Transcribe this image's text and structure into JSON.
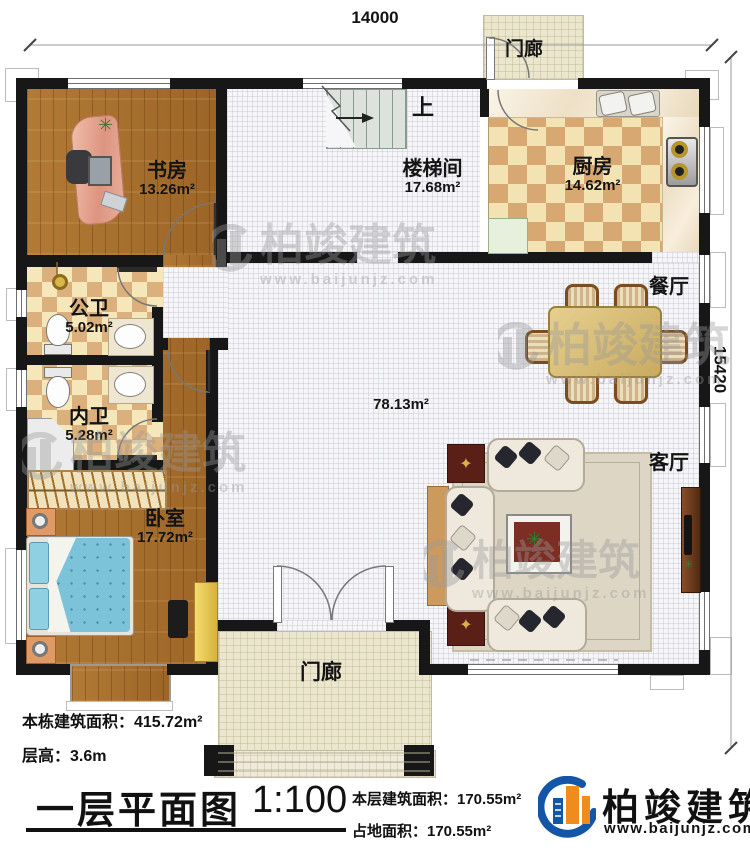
{
  "dimensions": {
    "width_label": "14000",
    "height_label": "15420"
  },
  "rooms": {
    "study": {
      "name": "书房",
      "area": "13.26m²"
    },
    "stairwell": {
      "name": "楼梯间",
      "area": "17.68m²",
      "up_label": "上"
    },
    "kitchen": {
      "name": "厨房",
      "area": "14.62m²"
    },
    "public_bath": {
      "name": "公卫",
      "area": "5.02m²"
    },
    "private_bath": {
      "name": "内卫",
      "area": "5.28m²"
    },
    "bedroom": {
      "name": "卧室",
      "area": "17.72m²"
    },
    "dining": {
      "name": "餐厅"
    },
    "living": {
      "name": "客厅"
    },
    "hall": {
      "area": "78.13m²"
    },
    "rear_porch": {
      "name": "门廊"
    },
    "front_porch": {
      "name": "门廊"
    }
  },
  "notes": {
    "building_area": "本栋建筑面积：415.72m²",
    "floor_height": "层高：3.6m"
  },
  "titleblock": {
    "title": "一层平面图",
    "scale": "1:100",
    "floor_area": "本层建筑面积：170.55m²",
    "footprint_area": "占地面积：170.55m²"
  },
  "brand": {
    "name": "柏竣建筑",
    "url": "www.baijunjz.com"
  },
  "watermark": {
    "name": "柏竣建筑",
    "url": "www.baijunjz.com"
  },
  "icons": {
    "plant": "✳",
    "ornament": "✦"
  },
  "colors": {
    "wall": "#171717",
    "wood": "#a9702c",
    "brand_blue": "#1356a8",
    "brand_orange": "#f08c1e",
    "checker_dark": "#d8a873",
    "checker_light": "#f4e3b2"
  }
}
